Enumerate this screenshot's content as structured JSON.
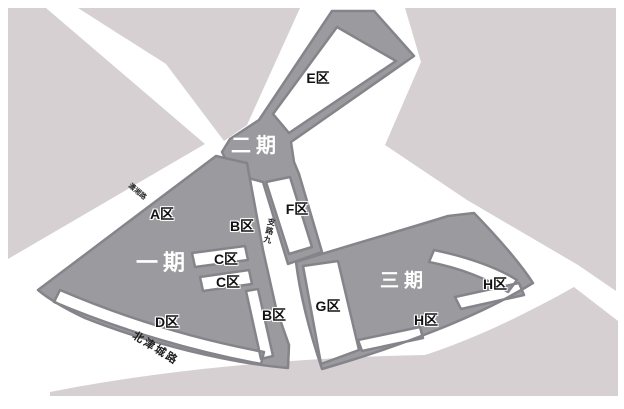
{
  "map": {
    "colors": {
      "background": "#ffffff",
      "city_block": "#d6d0d3",
      "zone_fill": "#9b9b9f",
      "zone_border": "#84848a",
      "label_dark": "#121212",
      "label_light": "#ffffff"
    },
    "phase_labels": {
      "phase1": "一期",
      "phase2": "二期",
      "phase3": "三期"
    },
    "zone_labels": {
      "e": "E区",
      "a": "A区",
      "b_upper": "B区",
      "f": "F区",
      "c_upper": "C区",
      "c_lower": "C区",
      "d": "D区",
      "b_lower": "B区",
      "g": "G区",
      "h_right": "H区",
      "h_lower": "H区"
    },
    "road_labels": {
      "beijincheng": "北津城路",
      "branch_nine": "支路九",
      "small_road": "潇湘路"
    }
  }
}
